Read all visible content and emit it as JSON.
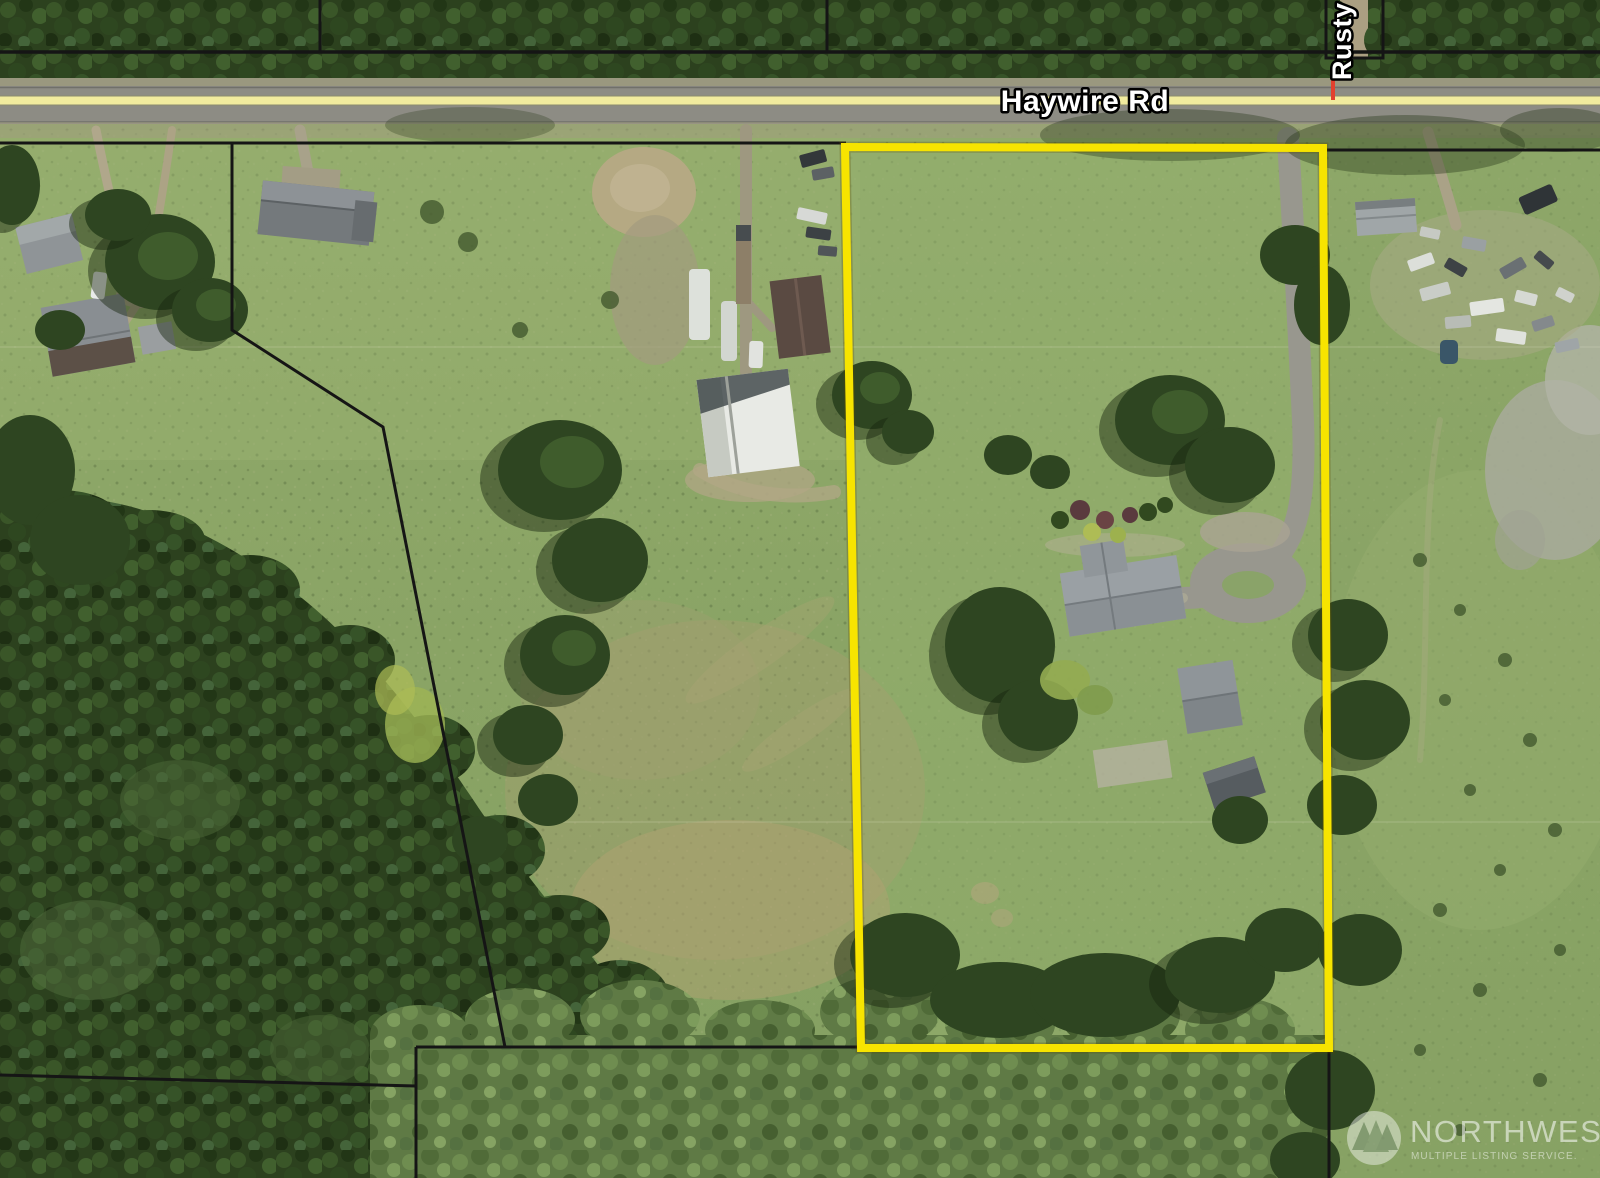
{
  "window": {
    "width": 1600,
    "height": 1178,
    "kind": "aerial parcel map photo"
  },
  "labels": {
    "main_road": "Haywire Rd",
    "side_road": "Rusty"
  },
  "watermark": {
    "brand": "NORTHWEST",
    "tagline": "MULTIPLE LISTING SERVICE."
  },
  "colors": {
    "property_boundary": "#f7e400",
    "parcel_line": "#151515",
    "road_centerline": "#f1eb9e",
    "side_road_marker": "#e2402e",
    "label_fill": "#ffffff",
    "label_outline": "#000000"
  }
}
